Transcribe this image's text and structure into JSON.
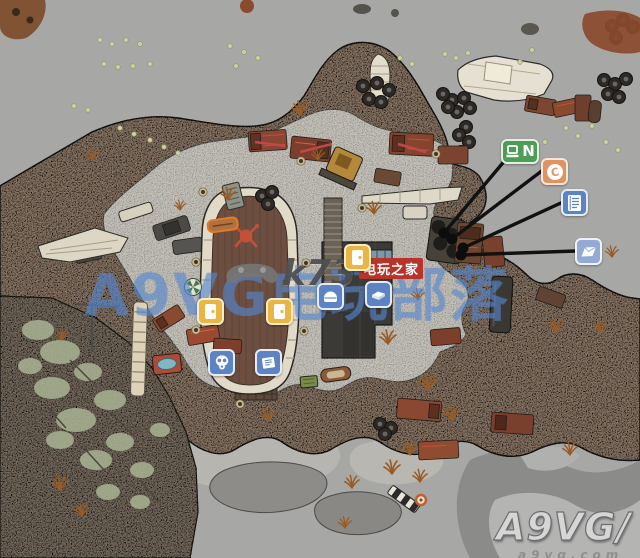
{
  "watermarks": {
    "k73": {
      "brand": "k73",
      "domain_suffix": ".com",
      "tagline": "电玩之家"
    },
    "overlay": {
      "text": "A9VG电玩部落"
    },
    "a9vg": {
      "brand": "A9VG",
      "slash": "/",
      "url": "a9vg.com"
    }
  },
  "markers": {
    "computer_note": {
      "label": "N",
      "icon": "laptop-icon"
    },
    "coin": {
      "label": "C",
      "icon": "coin-icon"
    },
    "ledger": {
      "icon": "notebook-icon"
    },
    "map_note": {
      "icon": "folded-map-icon"
    },
    "doors": {
      "icon": "door-icon",
      "count": 3
    },
    "helmet": {
      "icon": "helmet-icon"
    },
    "books": {
      "icon": "books-icon"
    },
    "gas_mask": {
      "icon": "gas-mask-icon"
    },
    "newspaper": {
      "icon": "newspaper-icon"
    }
  },
  "colors": {
    "marker_yellow": "#e9b544",
    "marker_blue": "#5c83c4",
    "marker_blue_light": "#93abd4",
    "marker_green": "#4d9c58",
    "marker_orange": "#df9361",
    "callout_line": "#111111",
    "water": "#a7a7a5",
    "terrain": "#8a7766",
    "gravel": "#c6c3bb"
  }
}
